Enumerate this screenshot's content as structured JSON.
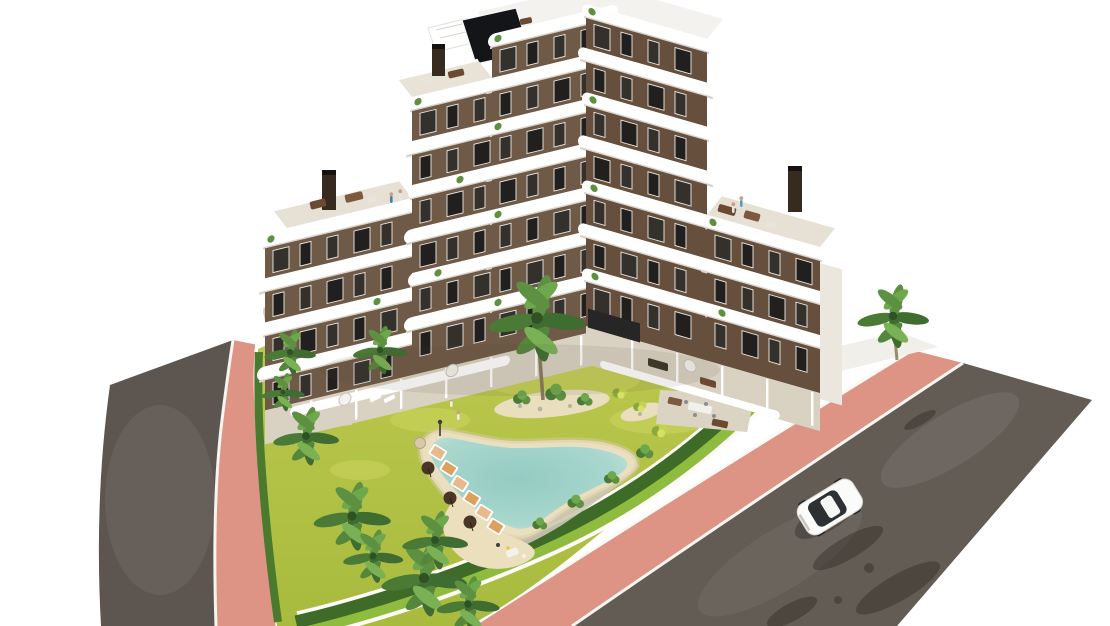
{
  "scene": {
    "type": "architectural-render",
    "description": "Aerial render of a modern V-shaped apartment building with white wave balconies, rooftop terraces, a landscaped garden with palm trees, a free-form lagoon pool with sun loungers, pink sidewalks, asphalt roads and one white car."
  },
  "colors": {
    "background": "#ffffff",
    "road": "#635c55",
    "road_left": "#5d5650",
    "sidewalk": "#dd9484",
    "sidewalk_light": "#e7a995",
    "curb": "#f7f5f0",
    "grass": "#b4c348",
    "grass_light": "#c8d557",
    "lawn_strip": "#8fbc3f",
    "hedge": "#3f6b28",
    "palm_dark": "#3f6c31",
    "palm_mid": "#5d9141",
    "palm_light": "#7ab155",
    "trunk": "#9c8a66",
    "pool_water": "#9ed2c9",
    "pool_water_edge": "#c7e5dc",
    "pool_sand": "#eadfbf",
    "gravel": "#ccc6b6",
    "sand_deck": "#ecdfbe",
    "wall_lit": "#6f5947",
    "wall_right": "#66503d",
    "wall_shaded": "#54422f",
    "window_dark": "#22201e",
    "window_mid": "#34312d",
    "window_frame": "#efece7",
    "slab": "#ffffff",
    "slab_shadow": "#d8d4cd",
    "terrace_floor": "#e6e1d4",
    "ground_terrace": "#d9d1c1",
    "paved_area": "#d5cbb6",
    "bbq_terrace": "#dcd4c3",
    "chimney": "#372a1e",
    "glass_dark": "#141519",
    "car_body": "#fbfbfa",
    "car_glass": "#2e3134",
    "shadow": "rgba(40,35,28,0.38)"
  },
  "building": {
    "wings": 2,
    "max_floors": 7,
    "roof_terraces": 3,
    "chimneys": 3,
    "style": "white curved balcony bands over brown facades"
  },
  "garden": {
    "palm_trees": 11,
    "sun_loungers": 6,
    "parasols": 4,
    "pool": "freeform lagoon with sand beach rim",
    "planting_islands": 2
  },
  "road_info": {
    "cars": 1,
    "car_color": "white",
    "sidewalk_material": "pink pavers"
  }
}
